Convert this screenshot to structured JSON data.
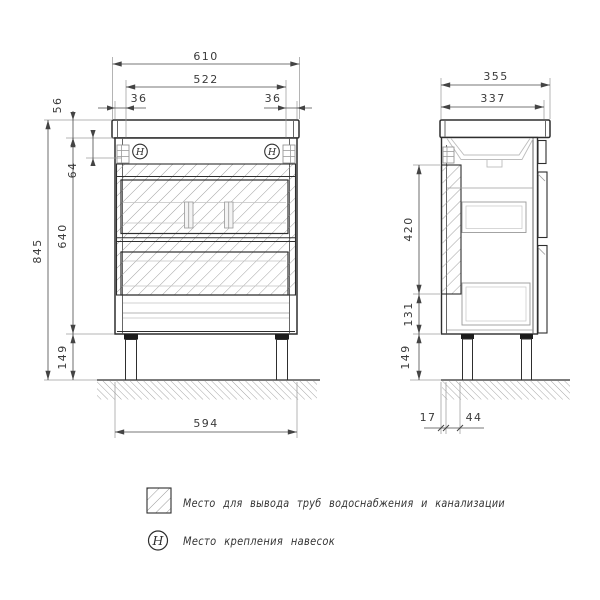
{
  "document_type": "furniture technical drawing (bathroom vanity, front and side views)",
  "colors": {
    "background": "#ffffff",
    "line_dark": "#2e2e2e",
    "line_light": "#9b9b9b",
    "hatch": "#979797",
    "text": "#3a3a3a"
  },
  "front_view": {
    "dim_width_top": "610",
    "dim_width_inner": "522",
    "dim_hanger_inset_left": "36",
    "dim_hanger_inset_right": "36",
    "dim_countertop_height": "56",
    "dim_hanger_drop": "64",
    "dim_body_height": "640",
    "dim_total_height": "845",
    "dim_leg_height": "149",
    "dim_width_bottom": "594",
    "hanger_symbol": "H"
  },
  "side_view": {
    "dim_depth_top": "355",
    "dim_depth_inner": "337",
    "dim_pipe_zone_height": "420",
    "dim_lower_height": "131",
    "dim_leg_height": "149",
    "dim_back_gap": "17",
    "dim_back_inset": "44"
  },
  "legend": {
    "items": [
      {
        "symbol_type": "hatched-square",
        "label": "Место для вывода труб водоснабжения и канализации"
      },
      {
        "symbol_type": "circled-letter",
        "symbol": "H",
        "label": "Место крепления навесок"
      }
    ]
  }
}
